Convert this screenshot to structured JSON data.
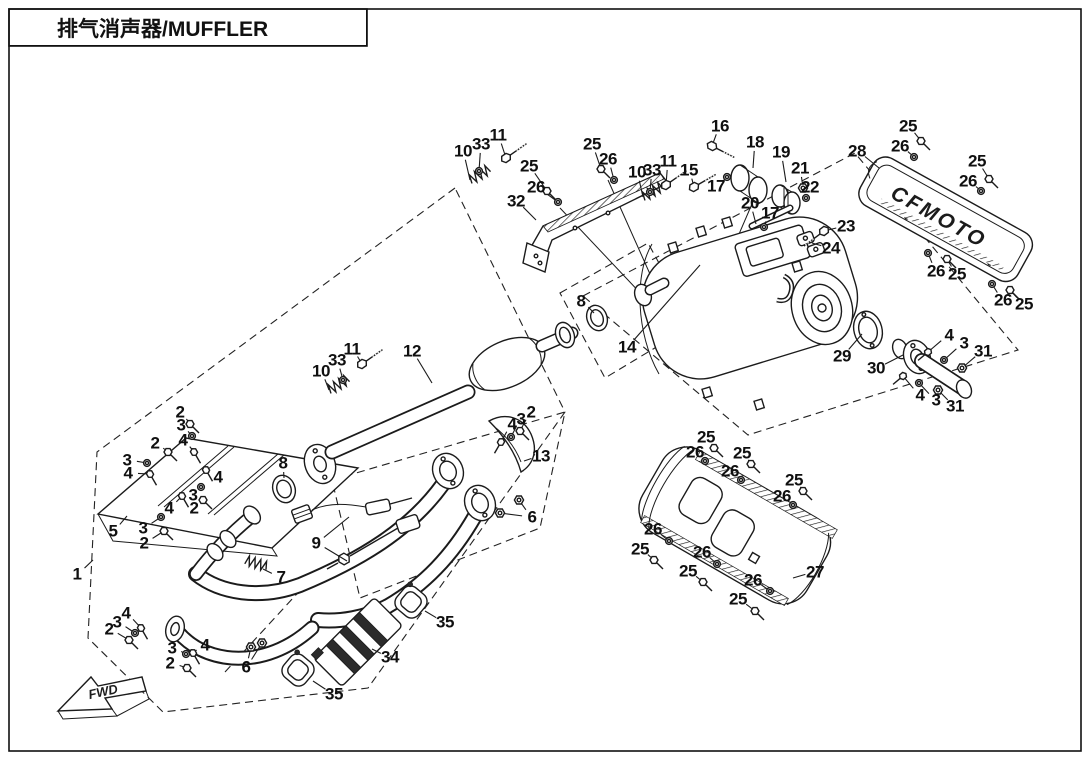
{
  "page": {
    "title": "排气消声器/MUFFLER"
  },
  "diagram": {
    "fwd_label": "FWD",
    "brand_logo": "CFMOTO",
    "callouts": [
      {
        "n": "10",
        "x": 463,
        "y": 151,
        "lx": 470,
        "ly": 180,
        "g": "spring",
        "r": -30
      },
      {
        "n": "33",
        "x": 481,
        "y": 144,
        "lx": 479,
        "ly": 171,
        "g": "washer"
      },
      {
        "n": "11",
        "x": 498,
        "y": 135,
        "lx": 506,
        "ly": 158,
        "g": "boltL",
        "r": -35
      },
      {
        "n": "25",
        "x": 529,
        "y": 166,
        "lx": 547,
        "ly": 191,
        "g": "screw"
      },
      {
        "n": "26",
        "x": 536,
        "y": 187,
        "lx": 558,
        "ly": 202,
        "g": "washer"
      },
      {
        "n": "32",
        "x": 516,
        "y": 201,
        "lx": 536,
        "ly": 220,
        "g": null
      },
      {
        "n": "25",
        "x": 592,
        "y": 144,
        "lx": 601,
        "ly": 169,
        "g": "screw"
      },
      {
        "n": "26",
        "x": 608,
        "y": 159,
        "lx": 614,
        "ly": 180,
        "g": "washer"
      },
      {
        "n": "10",
        "x": 637,
        "y": 172,
        "lx": 643,
        "ly": 197,
        "g": "spring",
        "r": -30
      },
      {
        "n": "33",
        "x": 652,
        "y": 170,
        "lx": 650,
        "ly": 192,
        "g": "washer"
      },
      {
        "n": "11",
        "x": 668,
        "y": 161,
        "lx": 666,
        "ly": 185,
        "g": "boltL",
        "r": -35
      },
      {
        "n": "15",
        "x": 689,
        "y": 170,
        "lx": 694,
        "ly": 187,
        "g": "boltL",
        "r": -30
      },
      {
        "n": "16",
        "x": 720,
        "y": 126,
        "lx": 712,
        "ly": 146,
        "g": "boltL",
        "r": 27
      },
      {
        "n": "18",
        "x": 755,
        "y": 142,
        "lx": 753,
        "ly": 168,
        "g": null
      },
      {
        "n": "19",
        "x": 781,
        "y": 152,
        "lx": 786,
        "ly": 182,
        "g": null
      },
      {
        "n": "21",
        "x": 800,
        "y": 168,
        "lx": 803,
        "ly": 188,
        "g": "nut"
      },
      {
        "n": "22",
        "x": 810,
        "y": 187,
        "lx": 806,
        "ly": 198,
        "g": "washer"
      },
      {
        "n": "17",
        "x": 716,
        "y": 186,
        "lx": 727,
        "ly": 177,
        "g": "washer"
      },
      {
        "n": "20",
        "x": 750,
        "y": 203,
        "lx": 756,
        "ly": 224,
        "g": null
      },
      {
        "n": "17",
        "x": 770,
        "y": 213,
        "lx": 764,
        "ly": 227,
        "g": "washer"
      },
      {
        "n": "23",
        "x": 846,
        "y": 226,
        "lx": 824,
        "ly": 231,
        "g": "boltL",
        "r": 143
      },
      {
        "n": "24",
        "x": 831,
        "y": 248,
        "lx": 812,
        "ly": 243,
        "g": null
      },
      {
        "n": "28",
        "x": 857,
        "y": 151,
        "lx": 879,
        "ly": 168,
        "g": null
      },
      {
        "n": "25",
        "x": 908,
        "y": 126,
        "lx": 921,
        "ly": 141,
        "g": "screw"
      },
      {
        "n": "26",
        "x": 900,
        "y": 146,
        "lx": 914,
        "ly": 157,
        "g": "washer"
      },
      {
        "n": "25",
        "x": 977,
        "y": 161,
        "lx": 989,
        "ly": 179,
        "g": "screw"
      },
      {
        "n": "26",
        "x": 968,
        "y": 181,
        "lx": 981,
        "ly": 191,
        "g": "washer"
      },
      {
        "n": "26",
        "x": 936,
        "y": 271,
        "lx": 928,
        "ly": 253,
        "g": "washer"
      },
      {
        "n": "25",
        "x": 957,
        "y": 274,
        "lx": 947,
        "ly": 259,
        "g": "screw"
      },
      {
        "n": "26",
        "x": 1003,
        "y": 300,
        "lx": 992,
        "ly": 284,
        "g": "washer"
      },
      {
        "n": "25",
        "x": 1024,
        "y": 304,
        "lx": 1010,
        "ly": 290,
        "g": "screw"
      },
      {
        "n": "8",
        "x": 581,
        "y": 301,
        "lx": 594,
        "ly": 313,
        "g": null
      },
      {
        "n": "14",
        "x": 627,
        "y": 347,
        "lx": 700,
        "ly": 265,
        "g": null
      },
      {
        "n": "29",
        "x": 842,
        "y": 356,
        "lx": 862,
        "ly": 334,
        "g": null
      },
      {
        "n": "30",
        "x": 876,
        "y": 368,
        "lx": 903,
        "ly": 355,
        "g": null
      },
      {
        "n": "4",
        "x": 949,
        "y": 335,
        "lx": 928,
        "ly": 352,
        "g": "bolt",
        "r": 140
      },
      {
        "n": "3",
        "x": 964,
        "y": 343,
        "lx": 944,
        "ly": 360,
        "g": "washer"
      },
      {
        "n": "31",
        "x": 983,
        "y": 351,
        "lx": 962,
        "ly": 368,
        "g": "nut"
      },
      {
        "n": "4",
        "x": 920,
        "y": 395,
        "lx": 903,
        "ly": 376,
        "g": "bolt",
        "r": 140
      },
      {
        "n": "3",
        "x": 936,
        "y": 400,
        "lx": 919,
        "ly": 383,
        "g": "washer"
      },
      {
        "n": "31",
        "x": 955,
        "y": 406,
        "lx": 938,
        "ly": 390,
        "g": "nut"
      },
      {
        "n": "10",
        "x": 321,
        "y": 371,
        "lx": 329,
        "ly": 390,
        "g": "spring",
        "r": -30
      },
      {
        "n": "33",
        "x": 337,
        "y": 360,
        "lx": 343,
        "ly": 380,
        "g": "washer"
      },
      {
        "n": "11",
        "x": 352,
        "y": 349,
        "lx": 362,
        "ly": 364,
        "g": "boltL",
        "r": -35
      },
      {
        "n": "12",
        "x": 412,
        "y": 351,
        "lx": 432,
        "ly": 383,
        "g": null
      },
      {
        "n": "2",
        "x": 180,
        "y": 412,
        "lx": 190,
        "ly": 424,
        "g": "screw"
      },
      {
        "n": "3",
        "x": 181,
        "y": 425,
        "lx": 192,
        "ly": 436,
        "g": "washer"
      },
      {
        "n": "4",
        "x": 183,
        "y": 440,
        "lx": 194,
        "ly": 452,
        "g": "bolt",
        "r": 60
      },
      {
        "n": "2",
        "x": 155,
        "y": 443,
        "lx": 168,
        "ly": 452,
        "g": "screw"
      },
      {
        "n": "3",
        "x": 127,
        "y": 460,
        "lx": 147,
        "ly": 463,
        "g": "washer"
      },
      {
        "n": "4",
        "x": 128,
        "y": 473,
        "lx": 150,
        "ly": 474,
        "g": "bolt",
        "r": 60
      },
      {
        "n": "4",
        "x": 218,
        "y": 477,
        "lx": 206,
        "ly": 470,
        "g": "bolt",
        "r": 60
      },
      {
        "n": "3",
        "x": 193,
        "y": 495,
        "lx": 201,
        "ly": 487,
        "g": "washer"
      },
      {
        "n": "2",
        "x": 194,
        "y": 508,
        "lx": 203,
        "ly": 500,
        "g": "screw"
      },
      {
        "n": "4",
        "x": 169,
        "y": 508,
        "lx": 182,
        "ly": 496,
        "g": "bolt",
        "r": 60
      },
      {
        "n": "3",
        "x": 143,
        "y": 528,
        "lx": 161,
        "ly": 517,
        "g": "washer"
      },
      {
        "n": "2",
        "x": 144,
        "y": 543,
        "lx": 164,
        "ly": 531,
        "g": "screw"
      },
      {
        "n": "5",
        "x": 113,
        "y": 531,
        "lx": 127,
        "ly": 516,
        "g": null
      },
      {
        "n": "8",
        "x": 283,
        "y": 463,
        "lx": 284,
        "ly": 478,
        "g": null
      },
      {
        "n": "2",
        "x": 531,
        "y": 412,
        "lx": 520,
        "ly": 431,
        "g": "screw"
      },
      {
        "n": "3",
        "x": 521,
        "y": 419,
        "lx": 511,
        "ly": 437,
        "g": "washer"
      },
      {
        "n": "4",
        "x": 512,
        "y": 424,
        "lx": 501,
        "ly": 442,
        "g": "bolt",
        "r": 120
      },
      {
        "n": "13",
        "x": 541,
        "y": 456,
        "lx": 524,
        "ly": 461,
        "g": null
      },
      {
        "n": "6",
        "x": 532,
        "y": 517,
        "lx": 519,
        "ly": 500,
        "lx2": 500,
        "ly2": 513,
        "g": "nut"
      },
      {
        "n": "9",
        "x": 316,
        "y": 543,
        "lx": 349,
        "ly": 517,
        "lx2": 347,
        "ly2": 561,
        "g": null
      },
      {
        "n": "1",
        "x": 77,
        "y": 574,
        "lx": 93,
        "ly": 560,
        "g": null
      },
      {
        "n": "7",
        "x": 281,
        "y": 577,
        "lx": 263,
        "ly": 569,
        "g": null
      },
      {
        "n": "4",
        "x": 126,
        "y": 613,
        "lx": 141,
        "ly": 628,
        "g": "bolt",
        "r": 60
      },
      {
        "n": "3",
        "x": 117,
        "y": 622,
        "lx": 135,
        "ly": 633,
        "g": "washer"
      },
      {
        "n": "2",
        "x": 109,
        "y": 629,
        "lx": 129,
        "ly": 640,
        "g": "screw"
      },
      {
        "n": "4",
        "x": 205,
        "y": 645,
        "lx": 193,
        "ly": 653,
        "g": "bolt",
        "r": 60
      },
      {
        "n": "3",
        "x": 172,
        "y": 648,
        "lx": 186,
        "ly": 654,
        "g": "washer"
      },
      {
        "n": "2",
        "x": 170,
        "y": 663,
        "lx": 187,
        "ly": 668,
        "g": "screw"
      },
      {
        "n": "6",
        "x": 246,
        "y": 667,
        "lx": 251,
        "ly": 647,
        "lx2": 262,
        "ly2": 643,
        "g": "nut"
      },
      {
        "n": "35",
        "x": 334,
        "y": 694,
        "lx": 313,
        "ly": 681,
        "g": null
      },
      {
        "n": "34",
        "x": 390,
        "y": 657,
        "lx": 372,
        "ly": 649,
        "g": null
      },
      {
        "n": "35",
        "x": 445,
        "y": 622,
        "lx": 425,
        "ly": 611,
        "g": null
      },
      {
        "n": "25",
        "x": 706,
        "y": 437,
        "lx": 714,
        "ly": 448,
        "g": "screw"
      },
      {
        "n": "26",
        "x": 695,
        "y": 452,
        "lx": 705,
        "ly": 461,
        "g": "washer"
      },
      {
        "n": "25",
        "x": 742,
        "y": 453,
        "lx": 751,
        "ly": 464,
        "g": "screw"
      },
      {
        "n": "26",
        "x": 730,
        "y": 471,
        "lx": 741,
        "ly": 480,
        "g": "washer"
      },
      {
        "n": "25",
        "x": 794,
        "y": 480,
        "lx": 803,
        "ly": 491,
        "g": "screw"
      },
      {
        "n": "26",
        "x": 782,
        "y": 496,
        "lx": 793,
        "ly": 505,
        "g": "washer"
      },
      {
        "n": "26",
        "x": 653,
        "y": 529,
        "lx": 669,
        "ly": 541,
        "g": "washer"
      },
      {
        "n": "25",
        "x": 640,
        "y": 549,
        "lx": 654,
        "ly": 560,
        "g": "screw"
      },
      {
        "n": "26",
        "x": 702,
        "y": 552,
        "lx": 717,
        "ly": 564,
        "g": "washer"
      },
      {
        "n": "25",
        "x": 688,
        "y": 571,
        "lx": 703,
        "ly": 582,
        "g": "screw"
      },
      {
        "n": "26",
        "x": 753,
        "y": 580,
        "lx": 770,
        "ly": 591,
        "g": "washer"
      },
      {
        "n": "25",
        "x": 738,
        "y": 599,
        "lx": 755,
        "ly": 611,
        "g": "screw"
      },
      {
        "n": "27",
        "x": 815,
        "y": 572,
        "lx": 793,
        "ly": 578,
        "g": null
      }
    ]
  }
}
